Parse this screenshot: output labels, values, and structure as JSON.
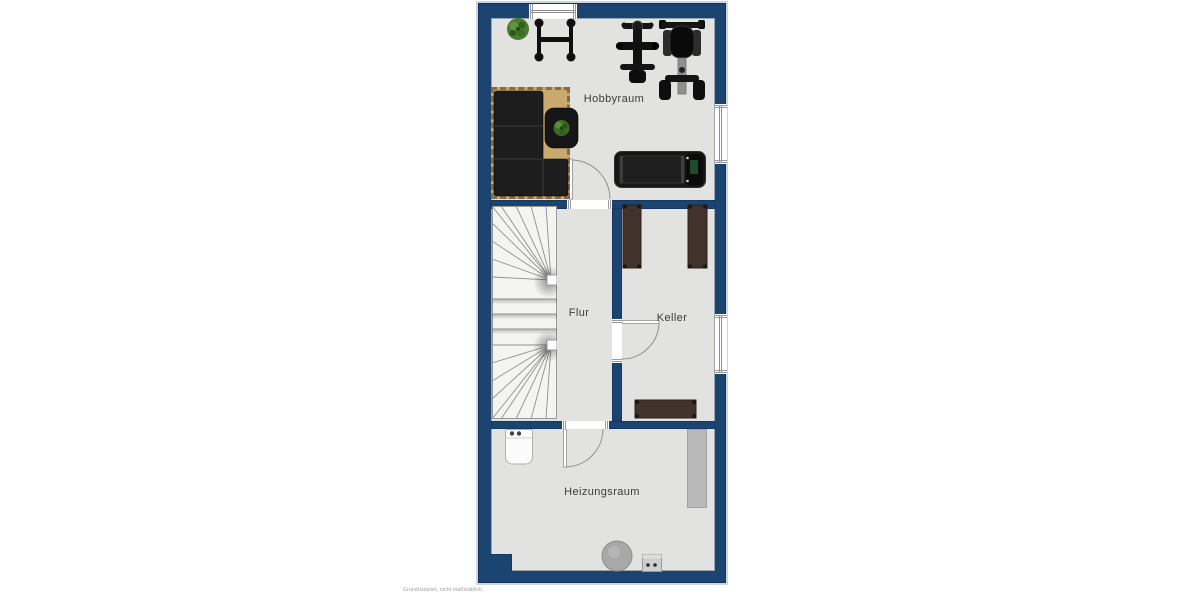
{
  "plan": {
    "rooms": {
      "hobbyraum": {
        "label": "Hobbyraum"
      },
      "flur": {
        "label": "Flur"
      },
      "keller": {
        "label": "Keller"
      },
      "heizungsraum": {
        "label": "Heizungsraum"
      }
    },
    "disclaimer": "Grundrissplan, nicht maßstäblich",
    "colors": {
      "wall": "#1b4470",
      "wall_edge": "#123459",
      "floor": "#e2e2e1",
      "outer_halo": "#ccd5e0",
      "rug": "#c9a96e",
      "rug_fringe": "#8a6b3f",
      "furniture_dark": "#161616",
      "shelf_brown": "#41332b",
      "appliance_gray": "#b9b9b9",
      "plant_green": "#4a7a2e",
      "label_text": "#3b3b3b"
    },
    "icons": {
      "plant-icon": "green-blob",
      "barbell-rack-icon": "h-frame",
      "gym-machine-icon": "cross-frame",
      "exercise-bike-icon": "seat-frame",
      "sofa-icon": "l-shape-black",
      "coffee-table-icon": "rounded-rect-plant",
      "treadmill-icon": "belt-rect",
      "shelf-icon": "brown-rect",
      "washing-machine-icon": "white-box-knobs",
      "radiator-icon": "gray-rect",
      "boiler-icon": "gray-circle",
      "utility-box-icon": "gray-box-dots",
      "stairs-icon": "winder-staircase",
      "window-icon": "double-glaze-line",
      "door-icon": "quarter-arc"
    }
  }
}
